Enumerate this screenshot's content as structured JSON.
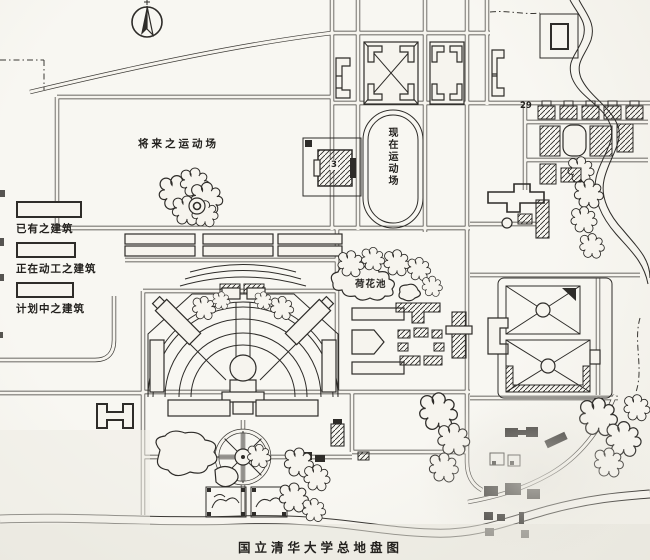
{
  "map": {
    "title": "国立清华大学总地盘图",
    "labels": {
      "future_field": "将来之运动场",
      "current_field": "现在运动场",
      "lotus_pond": "荷花池",
      "residential_number": "29",
      "gym_number": "3"
    },
    "legend": {
      "items": [
        {
          "label": "已有之建筑",
          "swatch": "hatched"
        },
        {
          "label": "正在动工之建筑",
          "swatch": "dotted"
        },
        {
          "label": "计划中之建筑",
          "swatch": "plain"
        }
      ]
    },
    "colors": {
      "paper": "#f6f4ee",
      "ink": "#2e2c29"
    }
  }
}
